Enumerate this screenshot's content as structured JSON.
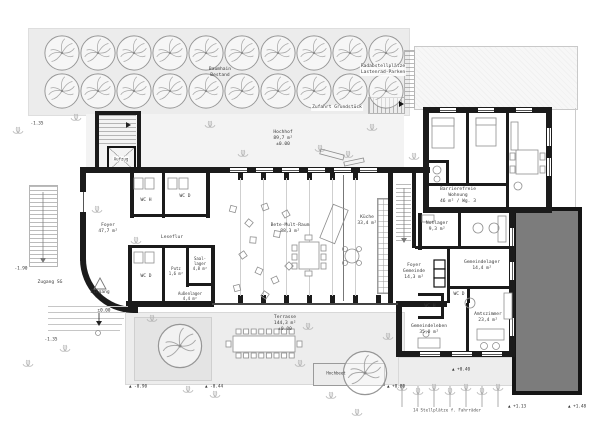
{
  "plan": {
    "labels": {
      "orchard": [
        "Baumhain",
        "Bestand"
      ],
      "bike": [
        "Radabstellplätze",
        "Lastenrad-Parken"
      ],
      "access": [
        "Zufahrt Grundstück"
      ],
      "hochhof": [
        "Hochhof",
        "89,7 m²",
        "±0.00"
      ],
      "aufzug": [
        "Aufzug"
      ],
      "zugang": [
        "Zugang SG"
      ],
      "eingang": [
        "Eingang"
      ],
      "foyer": [
        "Foyer",
        "47,7 m²"
      ],
      "wc_h": [
        "WC H"
      ],
      "wc_d": [
        "WC D"
      ],
      "leseflur": [
        "Leseflur"
      ],
      "wc_d2": [
        "WC D"
      ],
      "putz": [
        "Putz",
        "1,6 m²"
      ],
      "saallager": [
        "Saal-",
        "lager",
        "4,8 m²"
      ],
      "aussenlager": [
        "Außenlager",
        "4,4 m²"
      ],
      "saal": [
        "Bete-Mult-Raum",
        "88,3 m²"
      ],
      "kueche": [
        "Küche",
        "33,4 m²"
      ],
      "notlager": [
        "Notlager",
        "9,3 m²"
      ],
      "foyer_gemeinde": [
        "Foyer",
        "Gemeinde",
        "14,3 m²"
      ],
      "gemeindelager": [
        "Gemeindelager",
        "14,4 m²"
      ],
      "wc_d3": [
        "WC D"
      ],
      "wc_h2": [
        "WC H"
      ],
      "gemeindeleben": [
        "Gemeindeleben",
        "35,0 m²"
      ],
      "amtszimmer": [
        "Amtszimmer",
        "23,4 m²"
      ],
      "wohnung": [
        "Barrierefreie",
        "Wohnung",
        "46 m² / Wg. 3"
      ],
      "terrasse": [
        "Terrasse",
        "144,3 m²",
        "±0.00"
      ],
      "hochbeet": [
        "Hochbeet"
      ],
      "caption": [
        "14 Stellplätze f. Fahrräder"
      ]
    },
    "levels": [
      "-1.35",
      "-1.90",
      "±0.00",
      "-1.35",
      "▲ -0.90",
      "▲ -0.44",
      "▲ +0.80",
      "▲ +0.40",
      "▲ +1.13",
      "▲ +1.48"
    ],
    "colors": {
      "wall": "#1b1b1b",
      "site_gray": "#ececec",
      "building_mass": "#7c7c7c"
    }
  }
}
